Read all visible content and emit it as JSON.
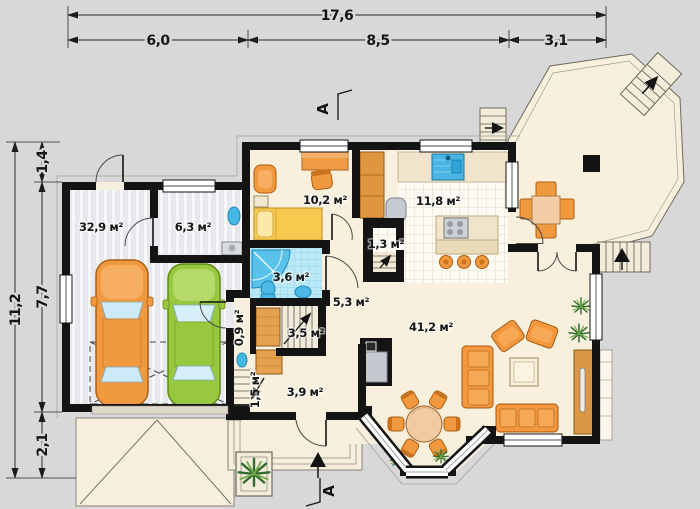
{
  "dimensions": {
    "top": {
      "total": "17,6",
      "segments": [
        "6,0",
        "8,5",
        "3,1"
      ]
    },
    "left": {
      "total": "11,2",
      "segments": [
        "1,4",
        "7,7",
        "2,1"
      ]
    }
  },
  "rooms": {
    "garage": "32,9 м²",
    "utility": "6,3 м²",
    "bedroom": "10,2 м²",
    "kitchen": "11,8 м²",
    "pantry": "1,3 м²",
    "bathroom": "3,6 м²",
    "closet": "0,9 м²",
    "stairs": "3,5 м²",
    "hall": "5,3 м²",
    "lower_stairs": "1,5 м²",
    "entry": "3,9 м²",
    "living": "41,2 м²"
  },
  "section": {
    "label": "A"
  },
  "colors": {
    "background": "#d8d8d8",
    "walls": "#141414",
    "floor_cream": "#f8f0dd",
    "furniture_orange": "#f5973d",
    "car_orange": "#f0993f",
    "car_green": "#97c83e",
    "water_blue": "#4db8e4",
    "bed_yellow": "#f6c94f",
    "wood_brown": "#dc9746"
  }
}
